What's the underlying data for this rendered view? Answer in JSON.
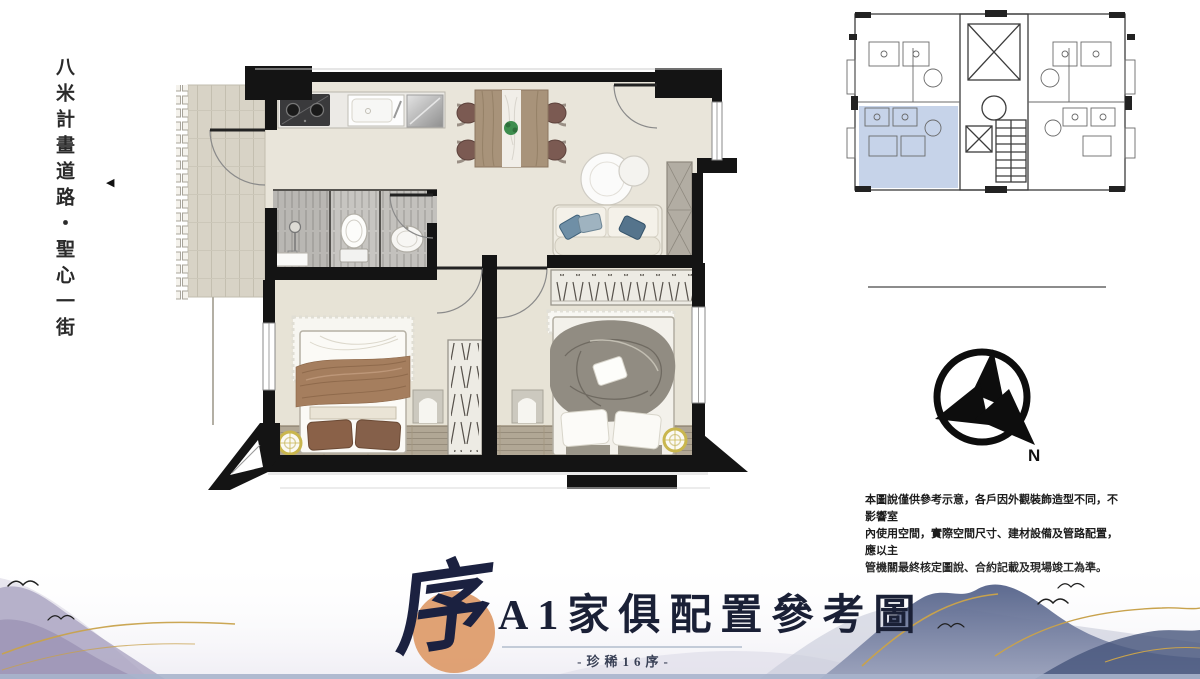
{
  "colors": {
    "accent_orange": "#dd9a68",
    "title_navy": "#1b2140",
    "keyplan_highlight": "#b9c9e4",
    "gold_line": "#c8a24c",
    "wall_black": "#141414",
    "floor_beige": "#e9e5da"
  },
  "road_label": {
    "text": "八米計畫道路・聖心一街",
    "arrow": "◀"
  },
  "compass": {
    "north_label": "N"
  },
  "disclaimer": {
    "lines": [
      "本圖說僅供參考示意，各戶因外觀裝飾造型不同，不影響室",
      "內使用空間，實際空間尺寸、建材設備及管路配置，應以主",
      "管機關最終核定圖說、合約記載及現場竣工為準。"
    ]
  },
  "title_block": {
    "seal_character": "序",
    "main_title": "A1家俱配置參考圖",
    "subtitle": "-珍稀16序-"
  }
}
